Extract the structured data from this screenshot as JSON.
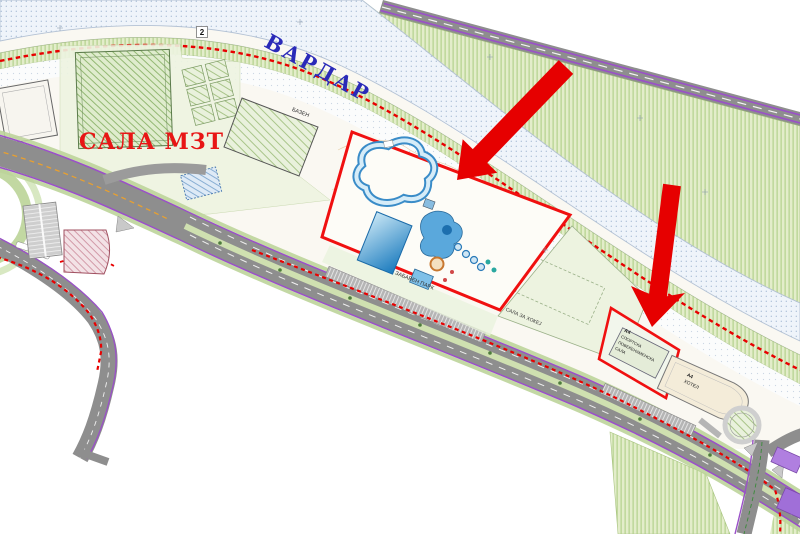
{
  "map": {
    "labels": {
      "river": "ВАРДАР",
      "mzt_hall": "САЛА МЗТ",
      "road_number": "2",
      "pool": "БАЗЕН",
      "amusement_park": "ЗАБАВЕН ПАРК",
      "hockey_hall": "САЛА ЗА ХОКЕЈ",
      "sports_hall_code": "А4",
      "sports_hall_name_line1": "СПОРТСКА",
      "sports_hall_name_line2": "ПОВЕЌЕНАМЕНСКА",
      "sports_hall_name_line3": "САЛА",
      "hotel_code": "А4",
      "hotel": "ХОТЕЛ"
    },
    "colors": {
      "river_label_blue": "#2a2ab8",
      "mzt_label_red": "#e81515",
      "annotation_arrow_red": "#e60000",
      "parcel_border_red": "#f01010",
      "boundary_dash_red": "#e80000",
      "greenbank_fill": "#e3edca",
      "road_gray": "#8e8e8e",
      "road_edge_purple": "#9a50c8",
      "river_fill": "#eff4fa",
      "pool_blue": "#1879bd",
      "median_green": "#cfe0b0"
    }
  }
}
